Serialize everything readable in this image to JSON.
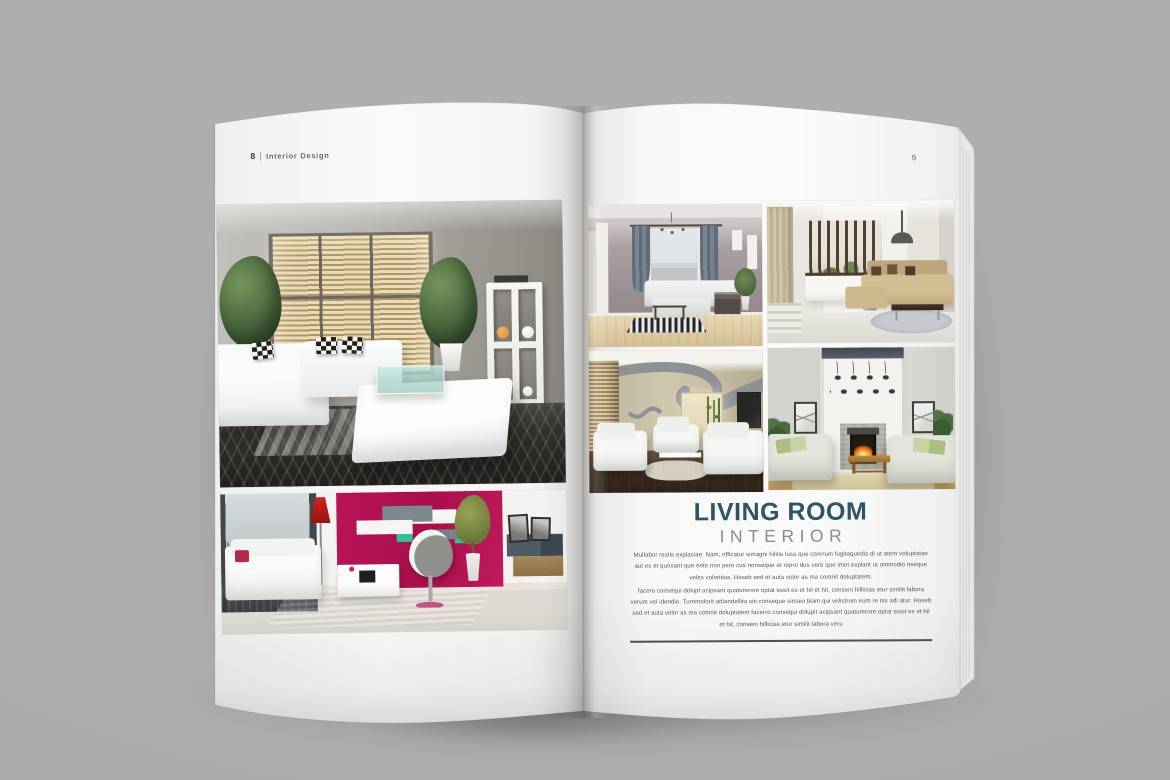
{
  "colors": {
    "accent-title": "#2f5466",
    "accent-subtitle": "#8c8c8c",
    "text-body": "#54545a",
    "accent-magenta": "#a90f4b",
    "accent-teal": "#2ec493",
    "accent-red-lamp": "#9a1210",
    "accent-orange": "#e0892b"
  },
  "magazine": {
    "left_page": {
      "header": {
        "page_number": "8",
        "separator": "|",
        "section": "Interior Design"
      },
      "photos": [
        {
          "label": "Living room with venetian blinds, white sectional sofa, plants and cube shelving"
        },
        {
          "label": "Modern living room with magenta accent wall, red floor lamp, wall shelves and swivel chair"
        }
      ]
    },
    "right_page": {
      "page_number": "9",
      "gallery": [
        {
          "label": "Classic living room with chandelier, gray curtains and white sofa"
        },
        {
          "label": "Open living room with wooden slat partition and beige sectional"
        },
        {
          "label": "Lounge with curved gray ceiling feature and white sofas"
        },
        {
          "label": "Living room with fireplace, pendant lights and two facing sofas"
        }
      ],
      "article": {
        "title": "LIVING ROOM",
        "subtitle": "INTERIOR",
        "paragraph_1": "Mullabor restis explaciae. Nam, officatur simagni hilitis lusa que conrrum fugitaquodis di ut atem voluptatae aut es et quosant que ente non pero cus nonseque et repro dus vere que imet explant ut ommodio nseque veles voloritius. Haseb sed et auta volor as ma comnit doluptatem.",
        "paragraph_2": "facero consequi dolupt acipsant quaturerore optat essit es et hil et hit, conseni hillicias etur similit labora verum vel idendio. Turemolorit adiandellita siti conseque simaio blam qui velistrum eum re nis adi atur. Haseb sed et auta volor as ma comnit doluptatem facerro consequi dolupit acipsant quaturerore optat essit es et hil et hit, conseni hillicias etur similit labora veru"
      }
    }
  }
}
